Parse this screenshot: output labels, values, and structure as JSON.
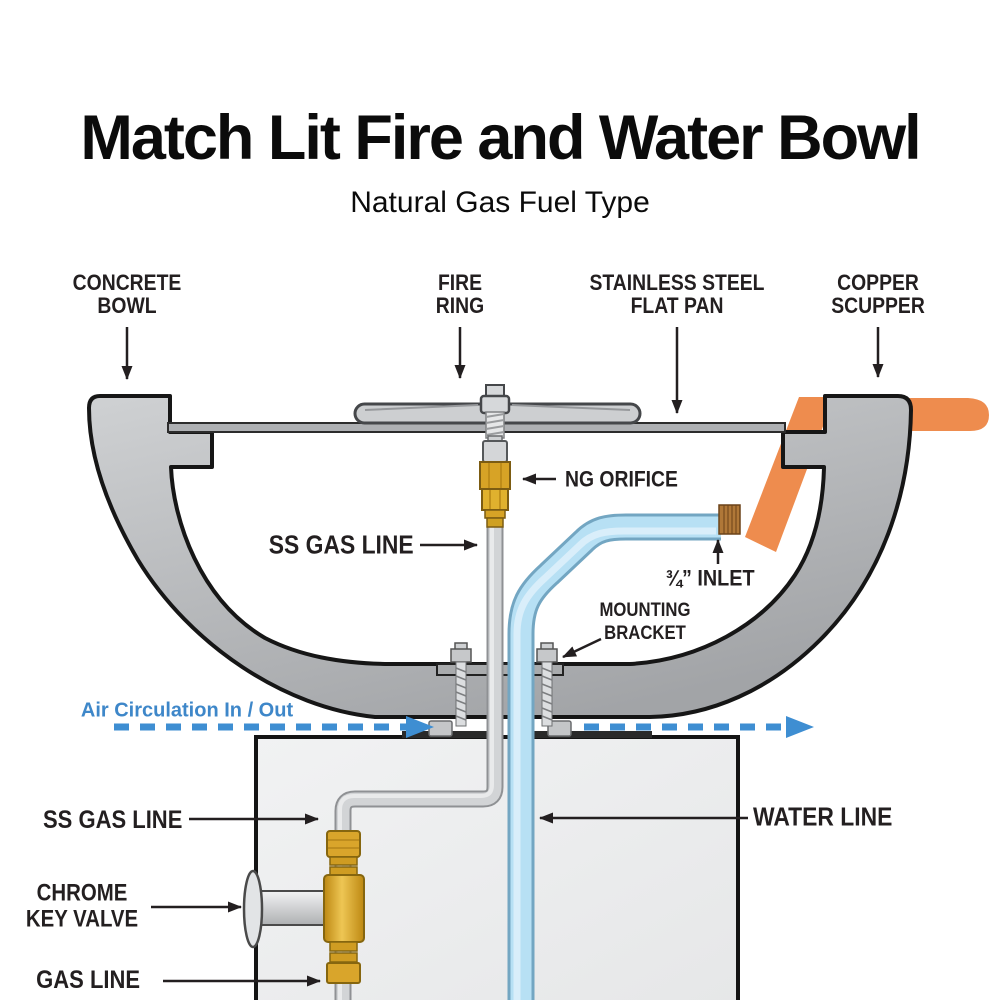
{
  "title": "Match Lit Fire and Water Bowl",
  "subtitle": "Natural Gas Fuel Type",
  "labels": {
    "concrete_bowl": "CONCRETE\nBOWL",
    "fire_ring": "FIRE\nRING",
    "flat_pan": "STAINLESS STEEL\nFLAT PAN",
    "copper_scupper": "COPPER\nSCUPPER",
    "ng_orifice": "NG ORIFICE",
    "ss_gas_line_upper": "SS GAS LINE",
    "inlet": "¾” INLET",
    "mounting_bracket": "MOUNTING\nBRACKET",
    "air_circulation": "Air Circulation In / Out",
    "water_line": "WATER LINE",
    "ss_gas_line_lower": "SS GAS LINE",
    "chrome_key_valve": "CHROME\nKEY VALVE",
    "gas_line": "GAS LINE"
  },
  "colors": {
    "bowl_gray": "#b4b6b9",
    "pedestal_gray": "#ededee",
    "copper_orange": "#ee8c4e",
    "water_blue": "#b7e0f4",
    "brass_gold": "#d9a52b",
    "air_blue": "#3e8ed2",
    "text_dark": "#231f20"
  }
}
